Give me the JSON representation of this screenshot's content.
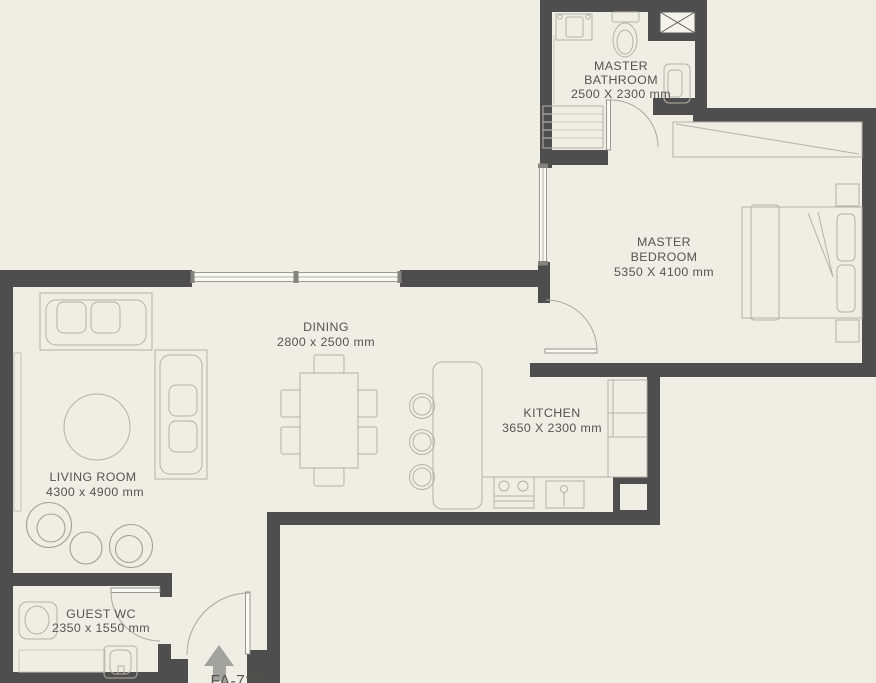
{
  "plan": {
    "unit_label": "FA-720",
    "rooms": {
      "master_bathroom": {
        "name": [
          "MASTER",
          "BATHROOM"
        ],
        "dims": "2500 X 2300 mm"
      },
      "master_bedroom": {
        "name": [
          "MASTER",
          "BEDROOM"
        ],
        "dims": "5350 X 4100 mm"
      },
      "dining": {
        "name": [
          "DINING"
        ],
        "dims": "2800 x 2500 mm"
      },
      "kitchen": {
        "name": [
          "KITCHEN"
        ],
        "dims": "3650 X 2300 mm"
      },
      "living_room": {
        "name": [
          "LIVING ROOM"
        ],
        "dims": "4300 x 4900 mm"
      },
      "guest_wc": {
        "name": [
          "GUEST WC"
        ],
        "dims": "2350 x 1550 mm"
      }
    },
    "colors": {
      "wall": "#4e4e4e",
      "background": "#f0ede5",
      "furniture_line": "#b4b1a8",
      "window_fill": "#fafaf5",
      "text": "#55544f",
      "entry_arrow": "#a2a29e"
    }
  }
}
